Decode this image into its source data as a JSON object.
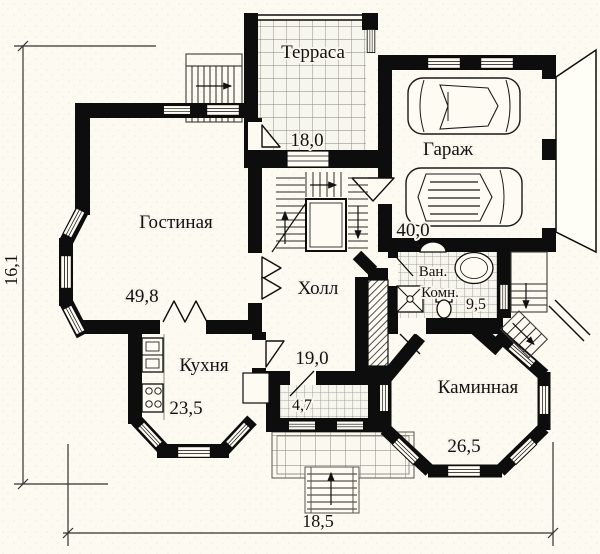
{
  "plan": {
    "title": "floor-plan-first-floor",
    "rooms": {
      "terrace": {
        "label": "Терраса",
        "area": "18,0"
      },
      "garage": {
        "label": "Гараж",
        "area": "40,0"
      },
      "living": {
        "label": "Гостиная",
        "area": "49,8"
      },
      "hall": {
        "label": "Холл",
        "area": "19,0"
      },
      "bathroom": {
        "label_line1": "Ван.",
        "label_line2": "Комн.",
        "area": "9,5"
      },
      "kitchen": {
        "label": "Кухня",
        "area": "23,5"
      },
      "fireplace": {
        "label": "Каминная",
        "area": "26,5"
      },
      "vestibule": {
        "area": "4,7"
      }
    },
    "dimensions": {
      "height_m": "16,1",
      "width_m": "18,5"
    },
    "colors": {
      "wall": "#0d0d0d",
      "paper": "#fcfaf1",
      "tile_line": "#85847a"
    }
  }
}
